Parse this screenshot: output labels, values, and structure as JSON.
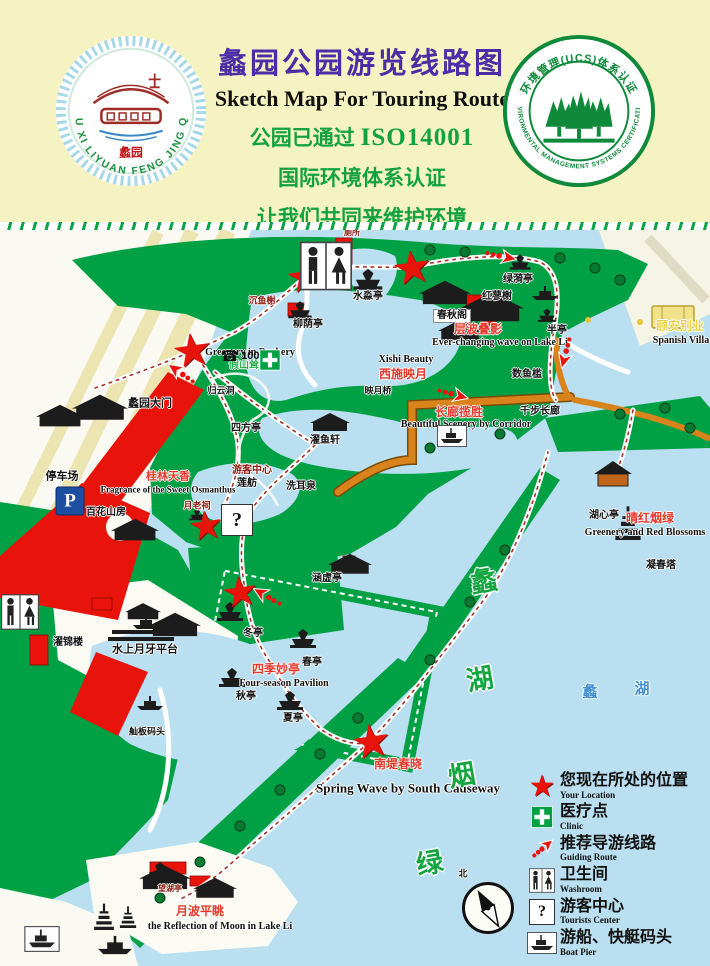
{
  "header": {
    "title_cn": "蠡园公园游览线路图",
    "title_en": "Sketch Map For Touring Route",
    "cert_line1_cn": "公园已通过",
    "cert_line1_code": "ISO14001",
    "cert_line2": "国际环境体系认证",
    "cert_line3": "让我们共同来维护环境",
    "badge_left": {
      "ring_text": "WU XI LIYUAN FENG JING QU",
      "center_seal": "蠡园"
    },
    "badge_right": {
      "ring_top": "环境管理(UCS)体系认证",
      "ring_bottom": "ENVIRONMENTAL MANAGEMENT SYSTEMS CERTIFICATION"
    }
  },
  "map": {
    "labels": [
      {
        "t": "蠡园大门",
        "x": 150,
        "y": 404,
        "c": "k",
        "s": 11
      },
      {
        "t": "停车场",
        "x": 62,
        "y": 477,
        "c": "k",
        "s": 11
      },
      {
        "t": "游客中心",
        "x": 252,
        "y": 471,
        "c": "dr",
        "s": 10
      },
      {
        "t": "百花山房",
        "x": 106,
        "y": 513,
        "c": "k",
        "s": 10
      },
      {
        "t": "桂林天香",
        "x": 168,
        "y": 477,
        "c": "r",
        "s": 11
      },
      {
        "t": "Fragrance of the Sweet Osmanthus",
        "x": 168,
        "y": 490,
        "c": "e",
        "s": 9
      },
      {
        "t": "月老祠",
        "x": 197,
        "y": 506,
        "c": "dr",
        "s": 9
      },
      {
        "t": "莲舫",
        "x": 247,
        "y": 484,
        "c": "k",
        "s": 10
      },
      {
        "t": "洗耳泉",
        "x": 301,
        "y": 487,
        "c": "k",
        "s": 10
      },
      {
        "t": "濯鱼轩",
        "x": 325,
        "y": 441,
        "c": "k",
        "s": 10
      },
      {
        "t": "四方亭",
        "x": 246,
        "y": 429,
        "c": "k",
        "s": 10
      },
      {
        "t": "归云洞",
        "x": 221,
        "y": 391,
        "c": "k",
        "s": 9
      },
      {
        "t": "Greenery in Rockery",
        "x": 250,
        "y": 353,
        "c": "e",
        "s": 10
      },
      {
        "t": "假山耸翠",
        "x": 249,
        "y": 366,
        "c": "gr",
        "s": 10
      },
      {
        "t": "水淼亭",
        "x": 368,
        "y": 297,
        "c": "k",
        "s": 10
      },
      {
        "t": "厕所",
        "x": 352,
        "y": 233,
        "c": "dr",
        "s": 8
      },
      {
        "t": "沉鱼榭",
        "x": 262,
        "y": 301,
        "c": "dr",
        "s": 9
      },
      {
        "t": "柳荫亭",
        "x": 308,
        "y": 325,
        "c": "k",
        "s": 10
      },
      {
        "t": "绿漪亭",
        "x": 518,
        "y": 280,
        "c": "k",
        "s": 10
      },
      {
        "t": "红蓼榭",
        "x": 497,
        "y": 297,
        "c": "k",
        "s": 10
      },
      {
        "t": "春秋阁",
        "x": 452,
        "y": 316,
        "c": "k",
        "s": 10,
        "box": true
      },
      {
        "t": "层波叠影",
        "x": 478,
        "y": 329,
        "c": "r",
        "s": 12
      },
      {
        "t": "Ever-changing wave on Lake Li",
        "x": 500,
        "y": 343,
        "c": "e",
        "s": 10
      },
      {
        "t": "半亭",
        "x": 557,
        "y": 331,
        "c": "k",
        "s": 10
      },
      {
        "t": "Xishi Beauty",
        "x": 406,
        "y": 360,
        "c": "e",
        "s": 10
      },
      {
        "t": "西施映月",
        "x": 403,
        "y": 374,
        "c": "r",
        "s": 12
      },
      {
        "t": "映月桥",
        "x": 378,
        "y": 391,
        "c": "k",
        "s": 9
      },
      {
        "t": "数鱼槛",
        "x": 527,
        "y": 375,
        "c": "k",
        "s": 10
      },
      {
        "t": "千步长廊",
        "x": 540,
        "y": 412,
        "c": "k",
        "s": 10
      },
      {
        "t": "长廊揽胜",
        "x": 459,
        "y": 412,
        "c": "r",
        "s": 12
      },
      {
        "t": "Beautiful Scenery by Corridor",
        "x": 466,
        "y": 425,
        "c": "e",
        "s": 10
      },
      {
        "t": "颐安别业",
        "x": 680,
        "y": 326,
        "c": "y",
        "s": 12
      },
      {
        "t": "Spanish Villa",
        "x": 681,
        "y": 341,
        "c": "e",
        "s": 10
      },
      {
        "t": "湖心亭",
        "x": 604,
        "y": 516,
        "c": "k",
        "s": 10
      },
      {
        "t": "晴红烟绿",
        "x": 650,
        "y": 518,
        "c": "r",
        "s": 12
      },
      {
        "t": "Greenery and Red Blossoms",
        "x": 645,
        "y": 533,
        "c": "e",
        "s": 10
      },
      {
        "t": "凝春塔",
        "x": 661,
        "y": 566,
        "c": "k",
        "s": 10
      },
      {
        "t": "涵虚亭",
        "x": 327,
        "y": 579,
        "c": "k",
        "s": 10
      },
      {
        "t": "冬亭",
        "x": 253,
        "y": 634,
        "c": "k",
        "s": 10
      },
      {
        "t": "春亭",
        "x": 312,
        "y": 663,
        "c": "k",
        "s": 10
      },
      {
        "t": "四季妙亭",
        "x": 276,
        "y": 669,
        "c": "r",
        "s": 12
      },
      {
        "t": "Four-season Pavilion",
        "x": 284,
        "y": 684,
        "c": "e",
        "s": 10
      },
      {
        "t": "秋亭",
        "x": 246,
        "y": 697,
        "c": "k",
        "s": 10
      },
      {
        "t": "夏亭",
        "x": 293,
        "y": 719,
        "c": "k",
        "s": 10
      },
      {
        "t": "南堤春晓",
        "x": 398,
        "y": 764,
        "c": "r",
        "s": 12
      },
      {
        "t": "Spring Wave by South Causeway",
        "x": 408,
        "y": 788,
        "c": "e",
        "s": 13
      },
      {
        "t": "濯锦楼",
        "x": 68,
        "y": 643,
        "c": "k",
        "s": 10
      },
      {
        "t": "水上月牙平台",
        "x": 145,
        "y": 650,
        "c": "k",
        "s": 11
      },
      {
        "t": "舢板码头",
        "x": 147,
        "y": 732,
        "c": "k",
        "s": 9
      },
      {
        "t": "望湖亭",
        "x": 170,
        "y": 889,
        "c": "dr",
        "s": 8
      },
      {
        "t": "月波平眺",
        "x": 200,
        "y": 911,
        "c": "r",
        "s": 12
      },
      {
        "t": "the Reflection of Moon in Lake Li",
        "x": 220,
        "y": 927,
        "c": "e",
        "s": 10
      },
      {
        "t": "蠡",
        "x": 484,
        "y": 582,
        "c": "g"
      },
      {
        "t": "湖",
        "x": 480,
        "y": 680,
        "c": "g"
      },
      {
        "t": "烟",
        "x": 462,
        "y": 776,
        "c": "g"
      },
      {
        "t": "绿",
        "x": 430,
        "y": 864,
        "c": "g"
      },
      {
        "t": "蠡",
        "x": 590,
        "y": 692,
        "c": "b"
      },
      {
        "t": "湖",
        "x": 642,
        "y": 689,
        "c": "b"
      },
      {
        "t": "北",
        "x": 463,
        "y": 874,
        "c": "k",
        "s": 9
      }
    ],
    "stars": [
      [
        192,
        350,
        46
      ],
      [
        305,
        277,
        44
      ],
      [
        412,
        267,
        46
      ],
      [
        206,
        526,
        40
      ],
      [
        240,
        592,
        42
      ],
      [
        371,
        741,
        46
      ]
    ],
    "arrows": [
      [
        500,
        256,
        12
      ],
      [
        452,
        394,
        15
      ],
      [
        566,
        352,
        105
      ],
      [
        268,
        597,
        210
      ],
      [
        182,
        374,
        215
      ]
    ],
    "icons": [
      {
        "type": "restroom",
        "x": 326,
        "y": 266,
        "w": 52
      },
      {
        "type": "restroom",
        "x": 20,
        "y": 612,
        "w": 38
      },
      {
        "type": "cross",
        "x": 270,
        "y": 360,
        "w": 21
      },
      {
        "type": "phone",
        "x": 240,
        "y": 356,
        "label": "100"
      },
      {
        "type": "parking",
        "x": 70,
        "y": 501,
        "label": "P",
        "w": 27
      },
      {
        "type": "question",
        "x": 237,
        "y": 520,
        "label": "?",
        "w": 30
      },
      {
        "type": "boat",
        "x": 452,
        "y": 436,
        "w": 30
      },
      {
        "type": "boat",
        "x": 42,
        "y": 939,
        "w": 36
      }
    ]
  },
  "legend": {
    "items": [
      {
        "icon": "star",
        "cn": "您现在所处的位置",
        "en": "Your Location"
      },
      {
        "icon": "cross",
        "cn": "医疗点",
        "en": "Clinic"
      },
      {
        "icon": "route",
        "cn": "推荐导游线路",
        "en": "Guiding Route"
      },
      {
        "icon": "washroom",
        "cn": "卫生间",
        "en": "Washroom"
      },
      {
        "icon": "question",
        "cn": "游客中心",
        "en": "Tourists Center"
      },
      {
        "icon": "boat",
        "cn": "游船、快艇码头",
        "en": "Boat Pier"
      }
    ]
  }
}
